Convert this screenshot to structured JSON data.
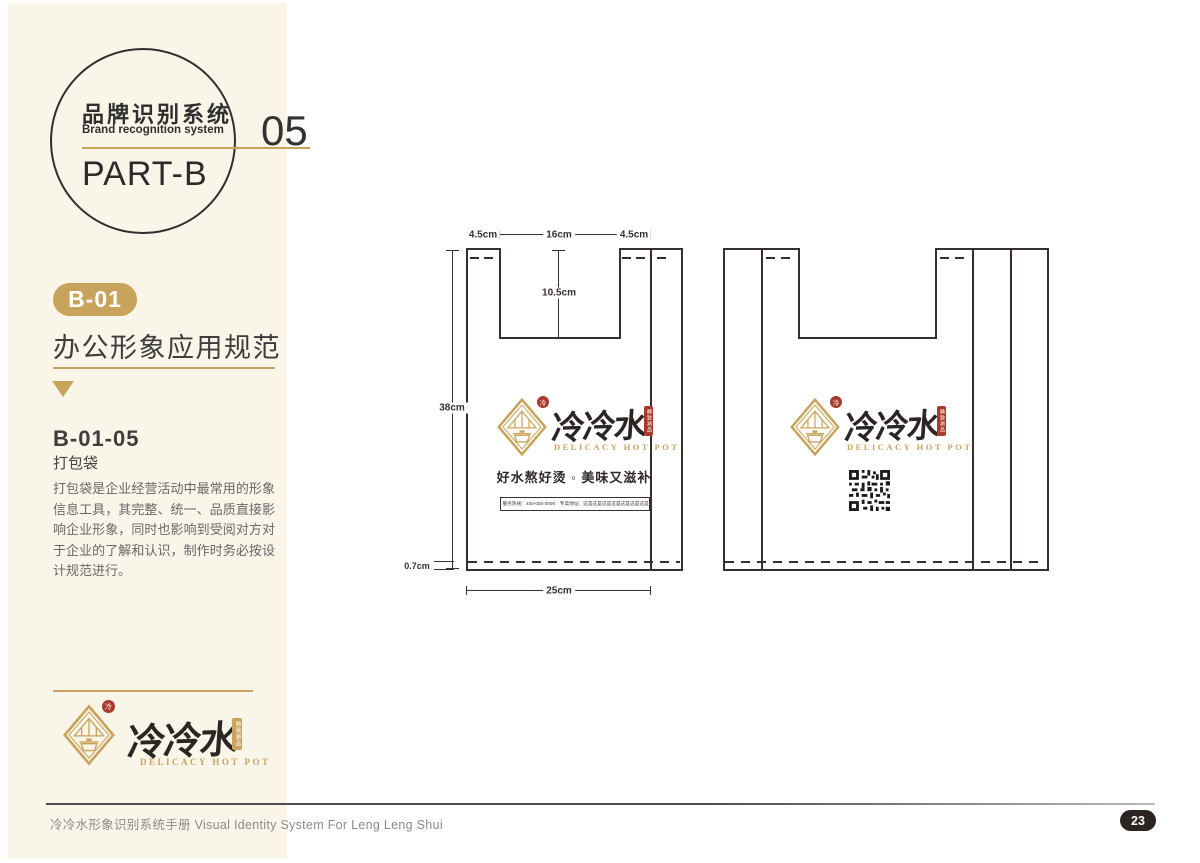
{
  "colors": {
    "cream_panel": "#f9f5e9",
    "gold_accent": "#c8a35b",
    "drawing_ink": "#362f2c",
    "seal_red": "#a73a2c",
    "page_badge_dark": "#2b2423"
  },
  "sidebar": {
    "circle": {
      "title_cn": "品牌识别系统",
      "title_en": "Brand recognition system",
      "part": "PART-B"
    },
    "section_number": "05",
    "badge_label": "B-01",
    "heading": "办公形象应用规范",
    "item_code": "B-01-05",
    "item_title": "打包袋",
    "paragraph": "打包袋是企业经营活动中最常用的形象信息工具，其完整、统一、品质直接影响企业形象，同时也影响到受阅对方对于企业的了解和认识，制作时务必按设计规范进行。"
  },
  "logo": {
    "name_cn": "冷冷水",
    "name_en": "DELICACY HOT POT",
    "seal_round": "冷",
    "seal_vertical": "精致涮品"
  },
  "drawing": {
    "dimensions": {
      "handle_width_left": "4.5cm",
      "mouth_width": "16cm",
      "handle_width_right": "4.5cm",
      "notch_depth": "10.5cm",
      "bag_height": "38cm",
      "bottom_fold": "0.7cm",
      "bag_width": "25cm"
    },
    "front_bag": {
      "tagline": "好水熬好烫 ◦ 美味又滋补",
      "info_text": "服务热线：400-000-0000　专卖地址：这是这是这是这是这是这是这是这是这是"
    }
  },
  "footer": {
    "manual_title": "冷冷水形象识别系统手册  Visual Identity System For Leng Leng Shui",
    "page_number": "23"
  }
}
